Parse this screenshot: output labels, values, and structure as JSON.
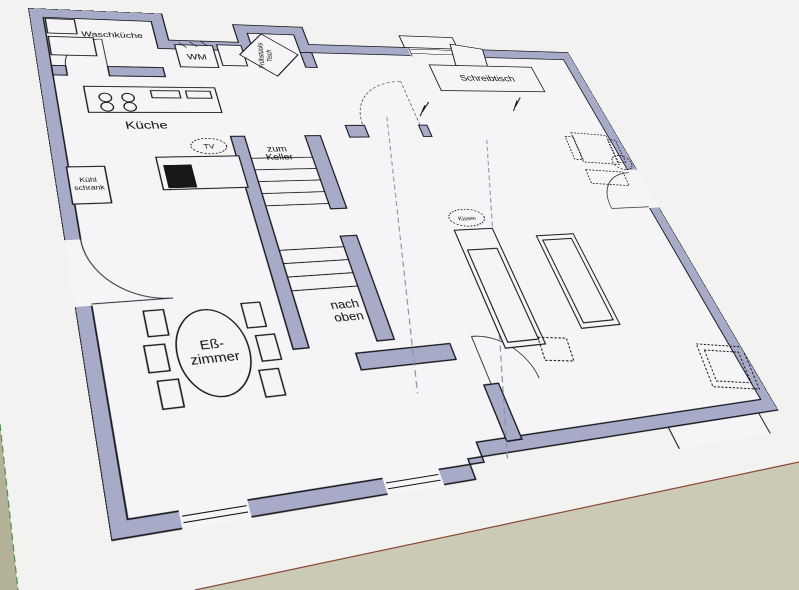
{
  "floorplan": {
    "rooms": {
      "laundry": "Waschküche",
      "kitchen": "Küche",
      "dining_line1": "Eß-",
      "dining_line2": "zimmer"
    },
    "features": {
      "washing_machine": "WM",
      "breakfast_table_line1": "Frühstücks",
      "breakfast_table_line2": "Tisch",
      "fridge_line1": "Kühl",
      "fridge_line2": "schrank",
      "desk": "Schreibtisch",
      "tv": "TV",
      "pillow": "Kissen"
    },
    "stairs": {
      "down_line1": "zum",
      "down_line2": "Keller",
      "up_line1": "nach",
      "up_line2": "oben"
    },
    "colors": {
      "wall": "#a7abc8",
      "outline": "#141418",
      "floor": "#f5f5f7",
      "paper": "#f2f2f1",
      "ground": "#cbcab4",
      "ground_far": "#b3b298",
      "axis_red": "#8a4a3a",
      "axis_green": "#4f8f4f",
      "guide": "#8a93a6"
    }
  }
}
